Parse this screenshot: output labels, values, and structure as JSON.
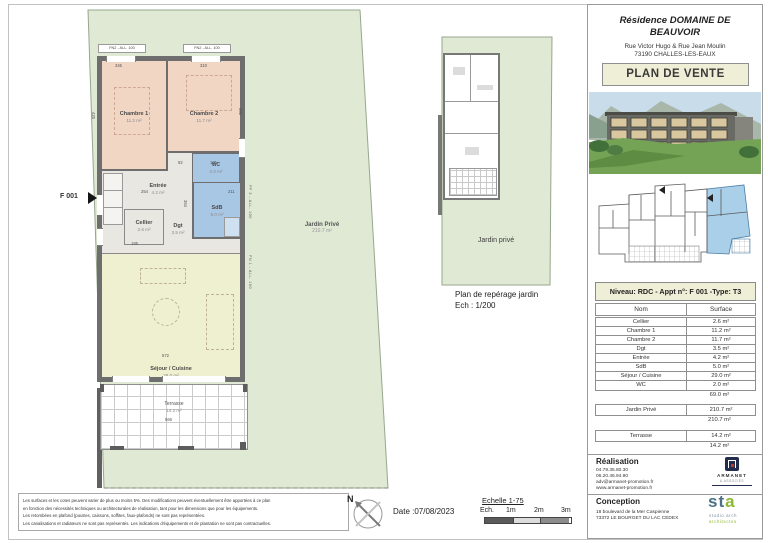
{
  "header": {
    "title_line1": "Résidence DOMAINE DE",
    "title_line2": "BEAUVOIR",
    "address_line1": "Rue Victor Hugo & Rue Jean Moulin",
    "address_line2": "73190 CHALLES-LES-EAUX",
    "banner": "PLAN DE VENTE"
  },
  "main_plan": {
    "unit_label": "F 001",
    "window_labels": [
      "FN2 - ALL. 100",
      "FN2 - ALL. 100"
    ],
    "side_labels": [
      "PF 2 - ALL. 100",
      "FN 1 - ALL. 100"
    ],
    "dims": [
      "345",
      "310",
      "254",
      "364",
      "211",
      "92",
      "171",
      "572",
      "566",
      "425",
      "390",
      "185"
    ],
    "rooms": {
      "chambre1": {
        "label": "Chambre 1",
        "area": "11.2 m²"
      },
      "chambre2": {
        "label": "Chambre 2",
        "area": "11.7 m²"
      },
      "wc": {
        "label": "WC",
        "area": "2.0 m²"
      },
      "sdb": {
        "label": "SdB",
        "area": "5.0 m²"
      },
      "entree": {
        "label": "Entrée",
        "area": "4.2 m²"
      },
      "cellier": {
        "label": "Cellier",
        "area": "2.6 m²"
      },
      "dgt": {
        "label": "Dgt",
        "area": "3.5 m²"
      },
      "sejour": {
        "label": "Séjour / Cuisine",
        "area": "29.0 m²"
      },
      "terrasse": {
        "label": "Terrasse",
        "area": "14.2 m²"
      },
      "jardin": {
        "label": "Jardin Privé",
        "area": "210.7 m²"
      }
    }
  },
  "reperage": {
    "jardin_label": "Jardin privé",
    "caption": "Plan de repérage jardin",
    "scale": "Ech : 1/200"
  },
  "surface_table": {
    "band": "Niveau: RDC - Appt n°: F 001 -Type: T3",
    "columns": {
      "name": "Nom",
      "surface": "Surface"
    },
    "rows": [
      {
        "name": "Cellier",
        "surface": "2.6 m²"
      },
      {
        "name": "Chambre 1",
        "surface": "11.2 m²"
      },
      {
        "name": "Chambre 2",
        "surface": "11.7 m²"
      },
      {
        "name": "Dgt",
        "surface": "3.5 m²"
      },
      {
        "name": "Entrée",
        "surface": "4.2 m²"
      },
      {
        "name": "SdB",
        "surface": "5.0 m²"
      },
      {
        "name": "Séjour / Cuisine",
        "surface": "29.0 m²"
      },
      {
        "name": "WC",
        "surface": "2.0 m²"
      }
    ],
    "total": "69.0 m²",
    "jardin": {
      "name": "Jardin Privé",
      "surface": "210.7 m²",
      "total": "210.7 m²"
    },
    "terrasse": {
      "name": "Terrasse",
      "surface": "14.2 m²",
      "total": "14.2 m²"
    }
  },
  "realisation": {
    "title": "Réalisation",
    "lines": [
      "04.79.35.80.30",
      "06.20.46.94.90",
      "adv@armanet-promotion.fr",
      "www.armanet-promotion.fr"
    ],
    "logo": {
      "name": "ARMANET",
      "sub": "& ASSOCIÉS"
    }
  },
  "conception": {
    "title": "Conception",
    "lines": [
      "18 boulevard de la Mer Caspienne",
      "73372 LE BOURGET DU LAC CEDEX"
    ],
    "logo": {
      "part1": "st",
      "part2": "a",
      "sub1": "studio arch",
      "sub2": "architectes"
    }
  },
  "footer": {
    "legal_lines": [
      "Les surfaces et les cotes peuvent varier de plus ou moins 5%. Des modifications peuvent éventuellement être apportées à ce plan",
      "en fonction des nécessités techniques ou architecturales de réalisation, tant pour les dimensions que pour les équipements.",
      "Les retombées en plafond (poutres, caissons, soffites, faux-plafonds) ne sont pas représentées.",
      "Les canalisations et radiateurs ne sont pas représentés. Les indications d'équipements et de plantation ne sont pas contractuelles."
    ],
    "compass_n": "N",
    "date": "Date :07/08/2023",
    "scale_title": "Echelle 1-75",
    "scale_prefix": "Ech.",
    "scale_ticks": [
      "1m",
      "2m",
      "3m"
    ]
  },
  "colors": {
    "jardin_green": "#dfe9d4",
    "room_pink": "#f1d6c4",
    "room_blue": "#a8c7e5",
    "sejour_yellow": "#eef0cf",
    "banner_cream": "#efefd7",
    "wall_gray": "#6e6e6e",
    "highlight_blue": "#a9cfe9",
    "logo_navy": "#232c4d",
    "logo_green": "#8cb832"
  }
}
